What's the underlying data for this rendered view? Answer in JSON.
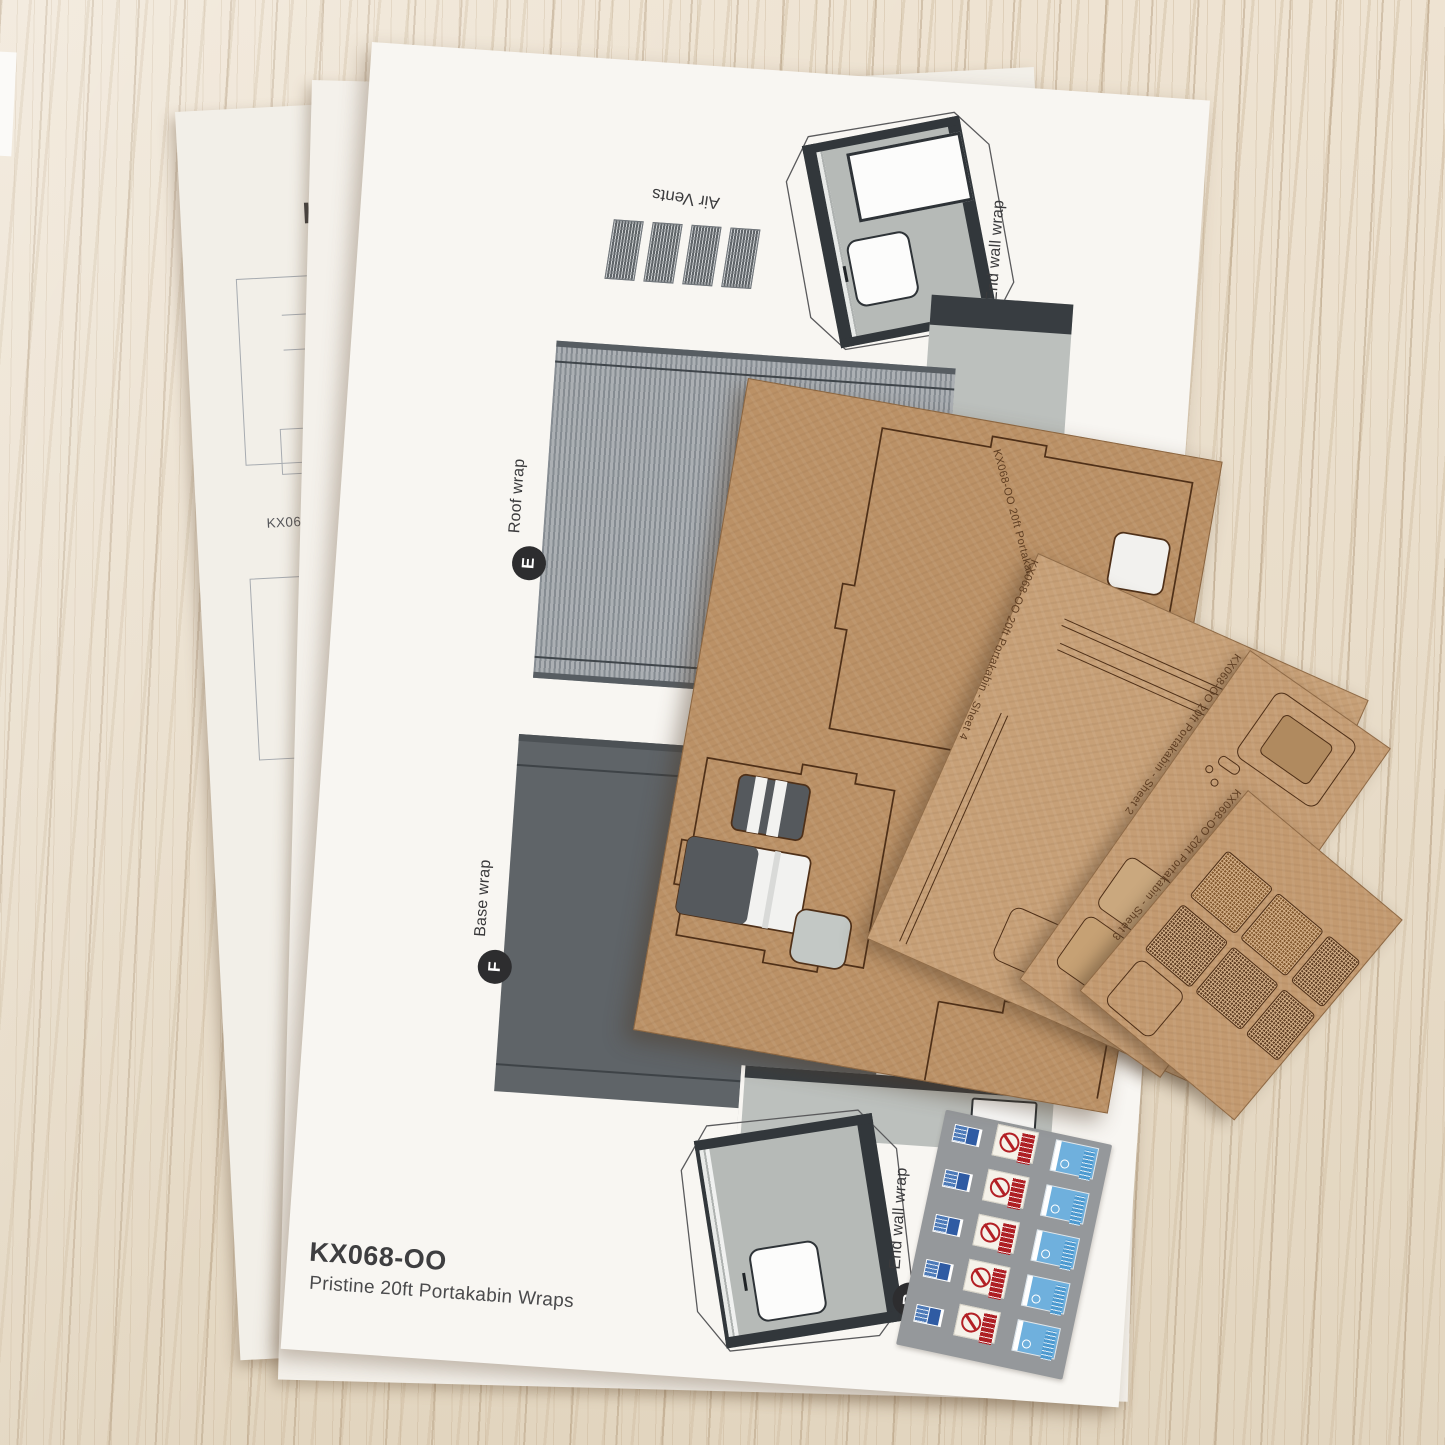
{
  "photo": {
    "subject": "Model kit contents on a wooden desk: printed wrap sheets and laser-cut sheets",
    "colors": {
      "wood": "#e8dcc8",
      "paper": "#f8f6f2",
      "mdf": "#bb9166",
      "card": "#c7a077",
      "engrave": "#5f3e22",
      "ink": "#3d4045",
      "panel_gray": "#b6bab7",
      "frame_dark": "#32373b",
      "roof_gray": "#9aa0a4",
      "base_gray": "#5f6468",
      "decal_bg": "#95989b",
      "badge_dark": "#2d2d2f",
      "sign_red": "#b32025",
      "sign_blue": "#6fb0dd"
    }
  },
  "instruction_sheet": {
    "partial_title": "Kit",
    "code": "KX068-OO"
  },
  "wraps_sheet": {
    "product_code": "KX068-OO",
    "product_name": "Pristine 20ft Portakabin Wraps",
    "air_vents_label": "Air Vents",
    "label_a": {
      "letter": "A",
      "text": "End wall wrap"
    },
    "label_e": {
      "letter": "E",
      "text": "Roof wrap"
    },
    "label_f": {
      "letter": "F",
      "text": "Base wrap"
    },
    "label_b": {
      "letter": "B",
      "text": "End wall wrap"
    }
  },
  "laser_sheets": {
    "sheet1": {
      "engraving": "KX068-OO 20ft Portakabin - Sheet 1"
    },
    "sheet4": {
      "engraving": "KX068-OO 20ft Portakabin - Sheet 4"
    },
    "sheet2": {
      "engraving": "KX068-OO 20ft Portakabin - Sheet 2"
    },
    "sheet3": {
      "engraving": "KX068-OO 20ft Portakabin - Sheet 3"
    }
  }
}
